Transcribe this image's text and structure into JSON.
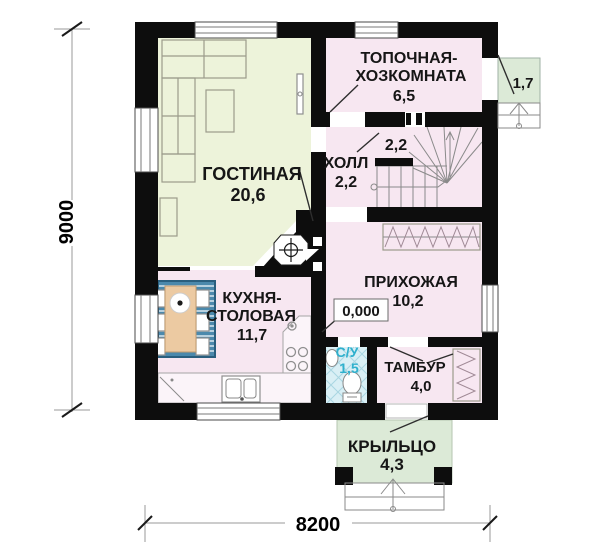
{
  "rooms": {
    "living": {
      "name": "ГОСТИНАЯ",
      "area": "20,6"
    },
    "boiler": {
      "line1": "ТОПОЧНАЯ-",
      "line2": "ХОЗКОМНАТА",
      "area": "6,5"
    },
    "hall": {
      "name": "ХОЛЛ",
      "area": "2,2"
    },
    "under_stairs": {
      "area": "2,2"
    },
    "entry": {
      "name": "ПРИХОЖАЯ",
      "area": "10,2",
      "floor_elevation": "0,000"
    },
    "kitchen": {
      "line1": "КУХНЯ-",
      "line2": "СТОЛОВАЯ",
      "area": "11,7"
    },
    "wc": {
      "name": "С/У",
      "area": "1,5"
    },
    "tambour": {
      "name": "ТАМБУР",
      "area": "4,0"
    },
    "porch": {
      "name": "КРЫЛЬЦО",
      "area": "4,3"
    },
    "side_porch": {
      "area": "1,7"
    }
  },
  "dimensions": {
    "bottom": "8200",
    "left": "9000"
  },
  "colors": {
    "wall": "#0d0d0d",
    "living_fill": "#edf3da",
    "room_fill": "#f7e7f1",
    "wc_fill": "#d9eff5",
    "porch_fill": "#dcead7",
    "wc_label": "#2fb0cd",
    "rug": "#4b89ac",
    "table": "#eccaa2"
  }
}
